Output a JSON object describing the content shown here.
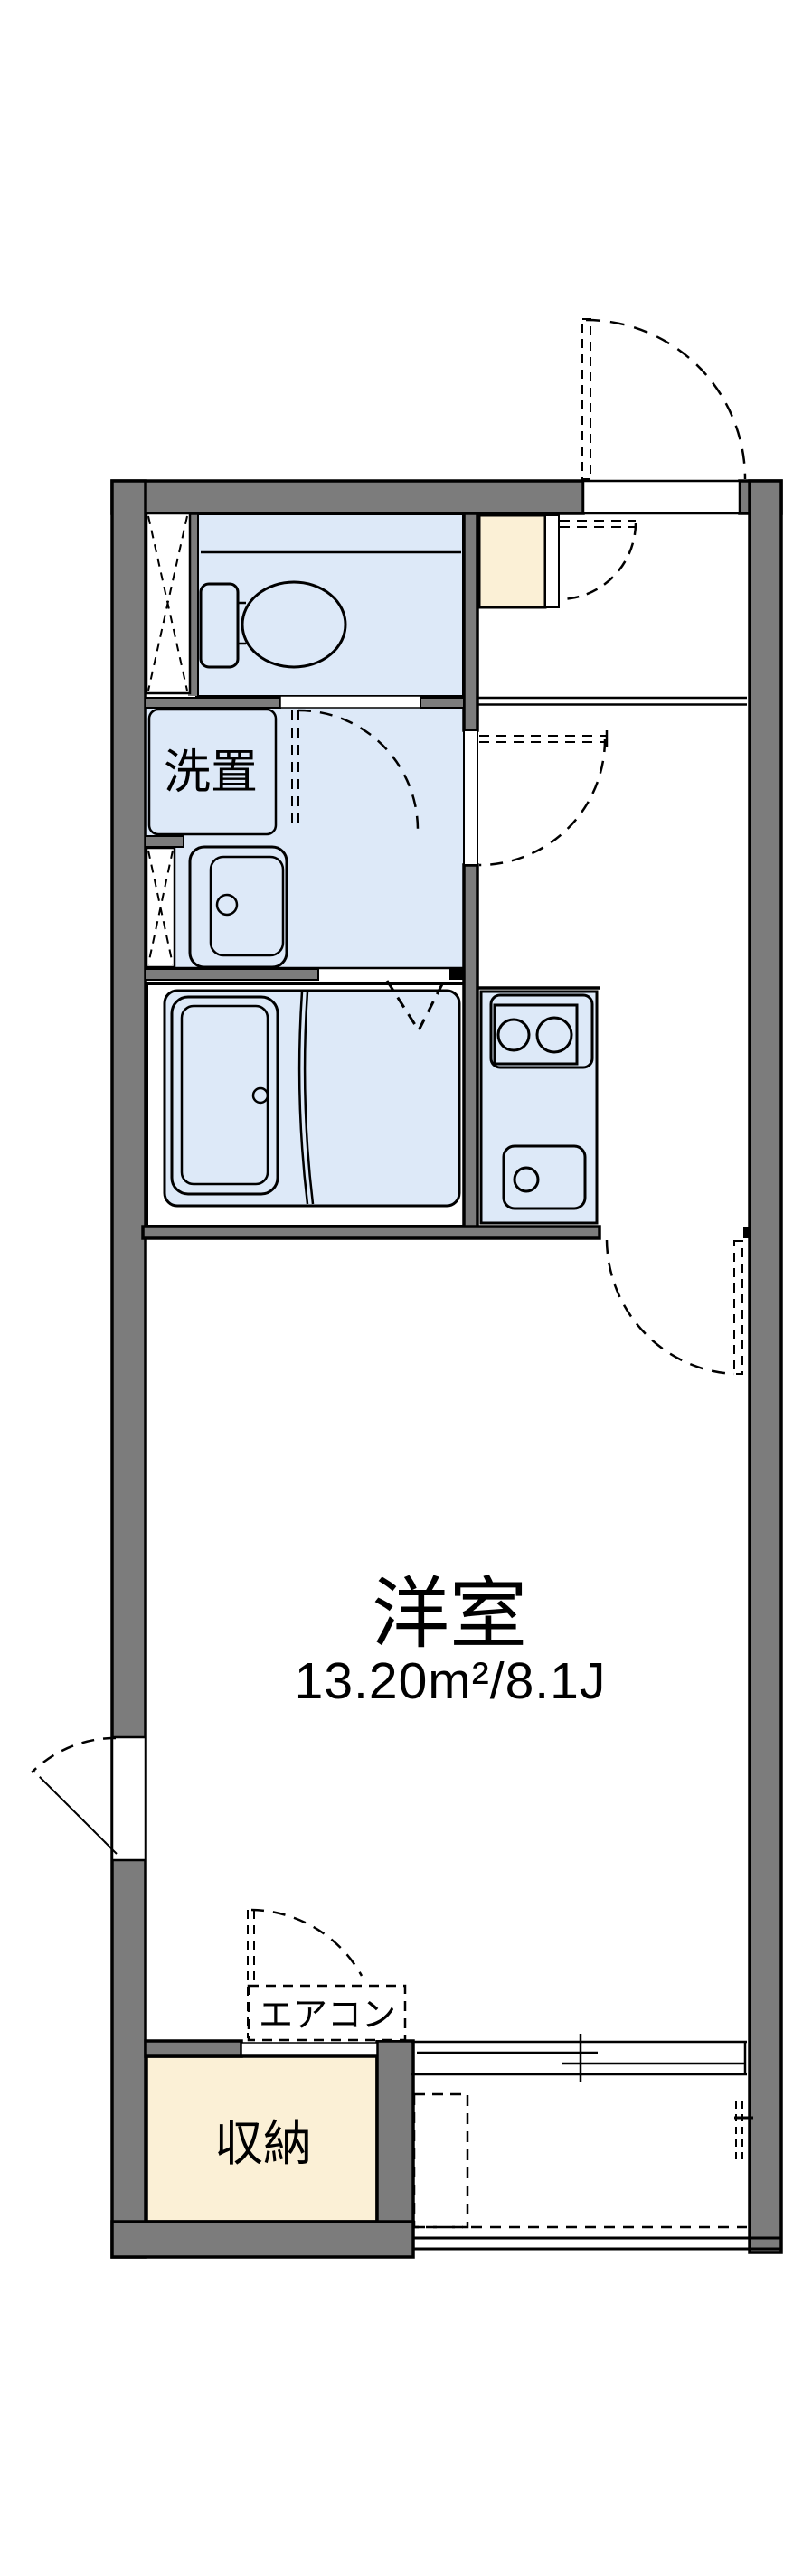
{
  "colors": {
    "wall": "#7C7C7C",
    "fixture": "#DDE9F8",
    "cream": "#FBF0D6",
    "line": "#000000",
    "background": "#FFFFFF"
  },
  "labels": {
    "washer_space": "洗置",
    "western_room": "洋室",
    "western_room_area": "13.20m²/8.1J",
    "air_conditioner": "エアコン",
    "storage": "収納"
  }
}
